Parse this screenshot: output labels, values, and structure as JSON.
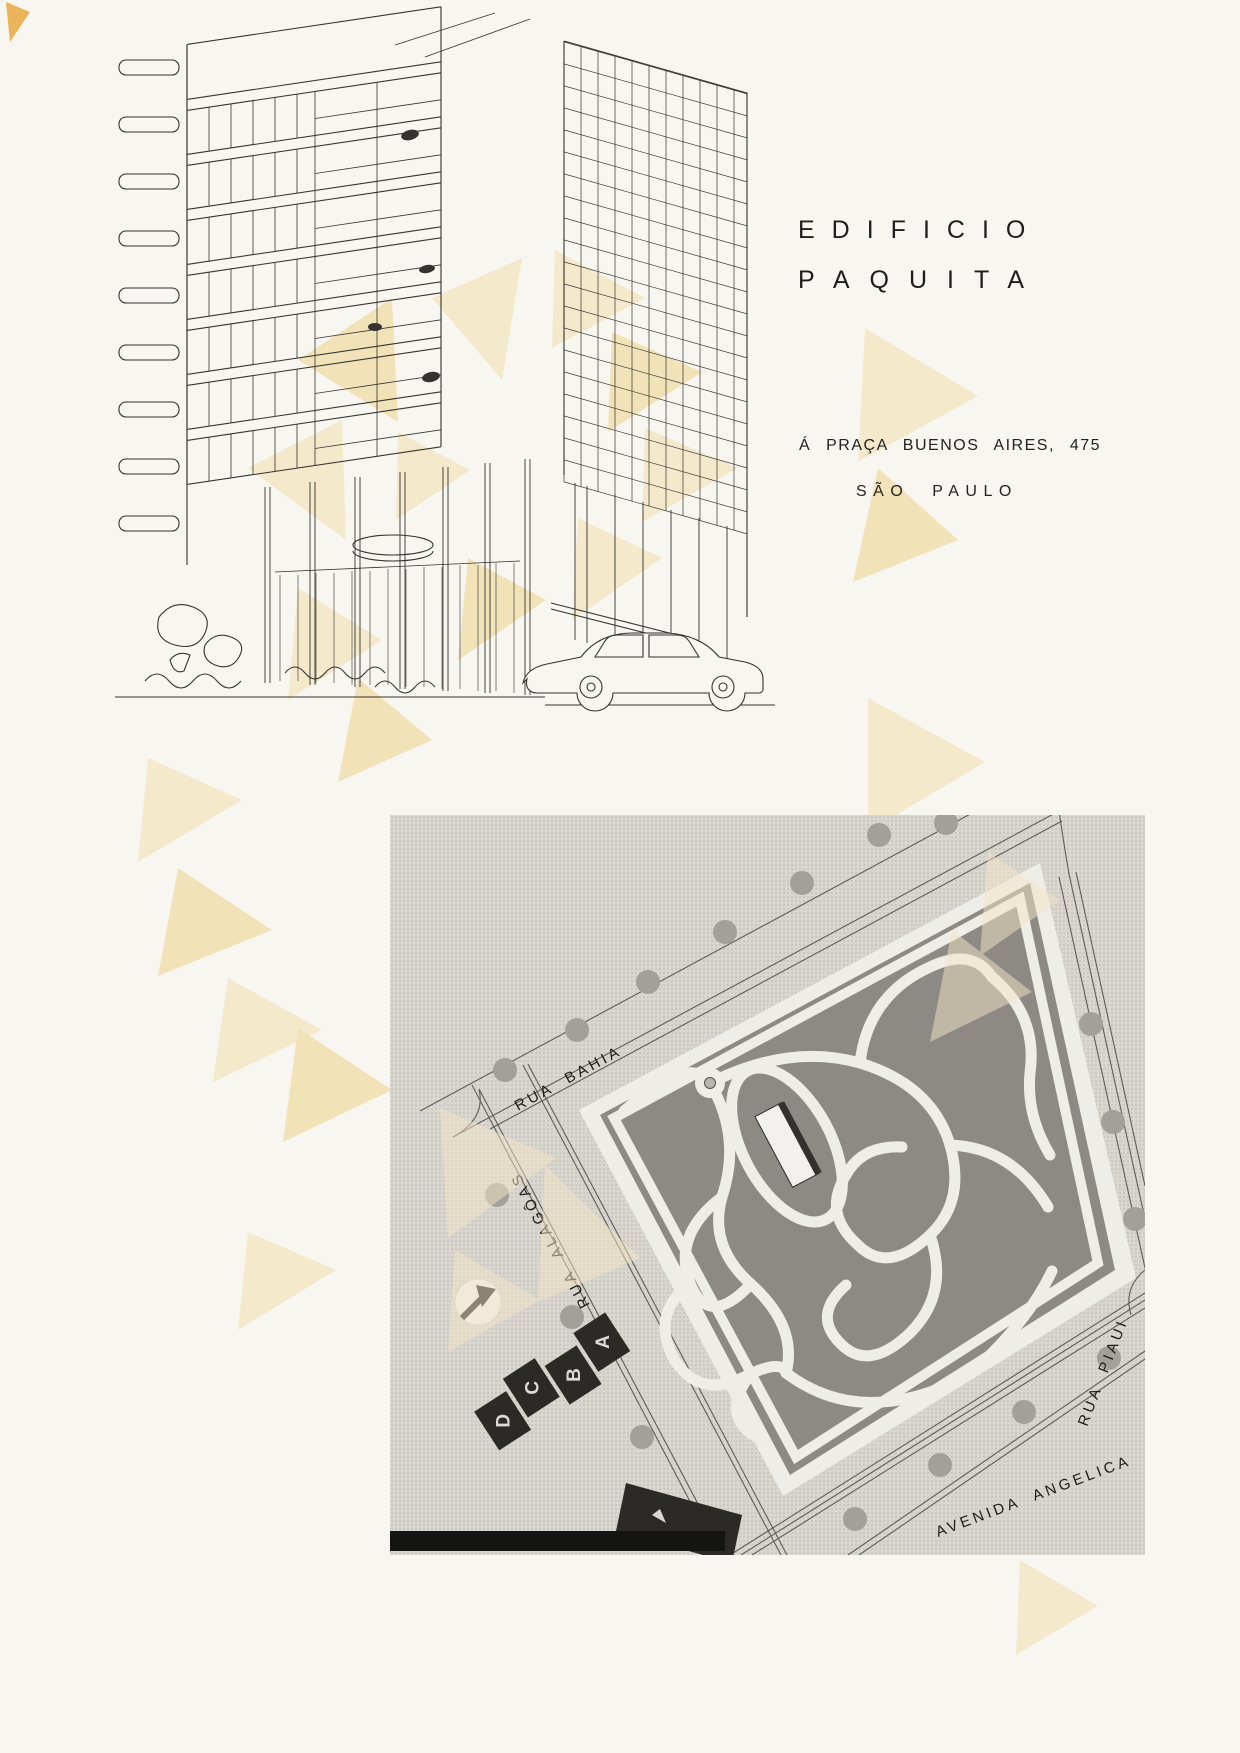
{
  "title": {
    "line1": "EDIFICIO",
    "line2": "PAQUITA"
  },
  "address": {
    "street": "Á PRAÇA BUENOS AIRES, 475",
    "city": "SÃO PAULO"
  },
  "map": {
    "street_labels": {
      "bahia": "RUA BAHIA",
      "alagoas": "RUA ALAGÔAS",
      "piaui": "RUA PIAUI",
      "angelica": "AVENIDA ANGELICA"
    },
    "block_letters": [
      "D",
      "C",
      "B",
      "A"
    ]
  },
  "colors": {
    "paper": "#f8f6f1",
    "watermark_cream": "#f5e9cc",
    "watermark_deep": "#f2e2b8",
    "photo_background": "#d9d6d0",
    "garden": "#8d8a85",
    "ink": "#35332f",
    "label_ink": "#1d1c1a"
  },
  "icons": {
    "north_arrow": "northeast-arrow"
  }
}
